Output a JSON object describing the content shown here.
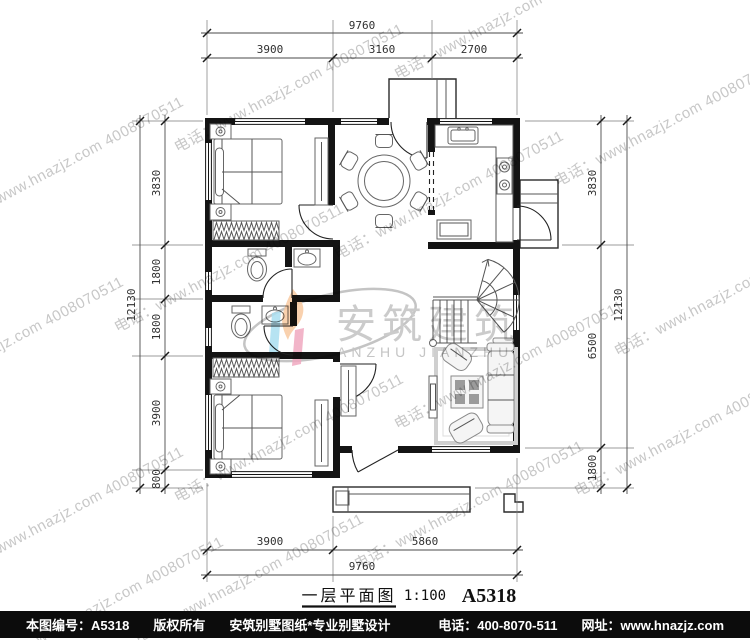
{
  "title_block": {
    "name": "一层平面图",
    "scale": "1:100",
    "sheet": "A5318"
  },
  "dims": {
    "top": {
      "total": "9760",
      "segments": [
        "3900",
        "3160",
        "2700"
      ]
    },
    "bottom": {
      "total": "9760",
      "segments": [
        "3900",
        "5860"
      ]
    },
    "left": {
      "total": "12130",
      "segments": [
        "3830",
        "1800",
        "1800",
        "3900",
        "800"
      ]
    },
    "right": {
      "total": "12130",
      "segments": [
        "3830",
        "6500",
        "1800"
      ]
    }
  },
  "footer": {
    "sheet_no": "本图编号：A5318",
    "copyright": "版权所有",
    "brand": "安筑别墅图纸*专业别墅设计",
    "phone": "电话：400-8070-511",
    "website": "网址：www.hnazjz.com"
  },
  "watermark": {
    "line": "电话：www.hnazjz.com 4008070511",
    "logo_cn": "安筑建筑",
    "logo_en": "ANZHU JIANZHU"
  },
  "colors": {
    "logo_pink": "#f0a8c0",
    "logo_cyan": "#a9def0",
    "logo_orange": "#f8c9a0",
    "watermark_gray": "#c7c7c7",
    "footer_bg": "#0c0c0c",
    "line_black": "#141414"
  }
}
